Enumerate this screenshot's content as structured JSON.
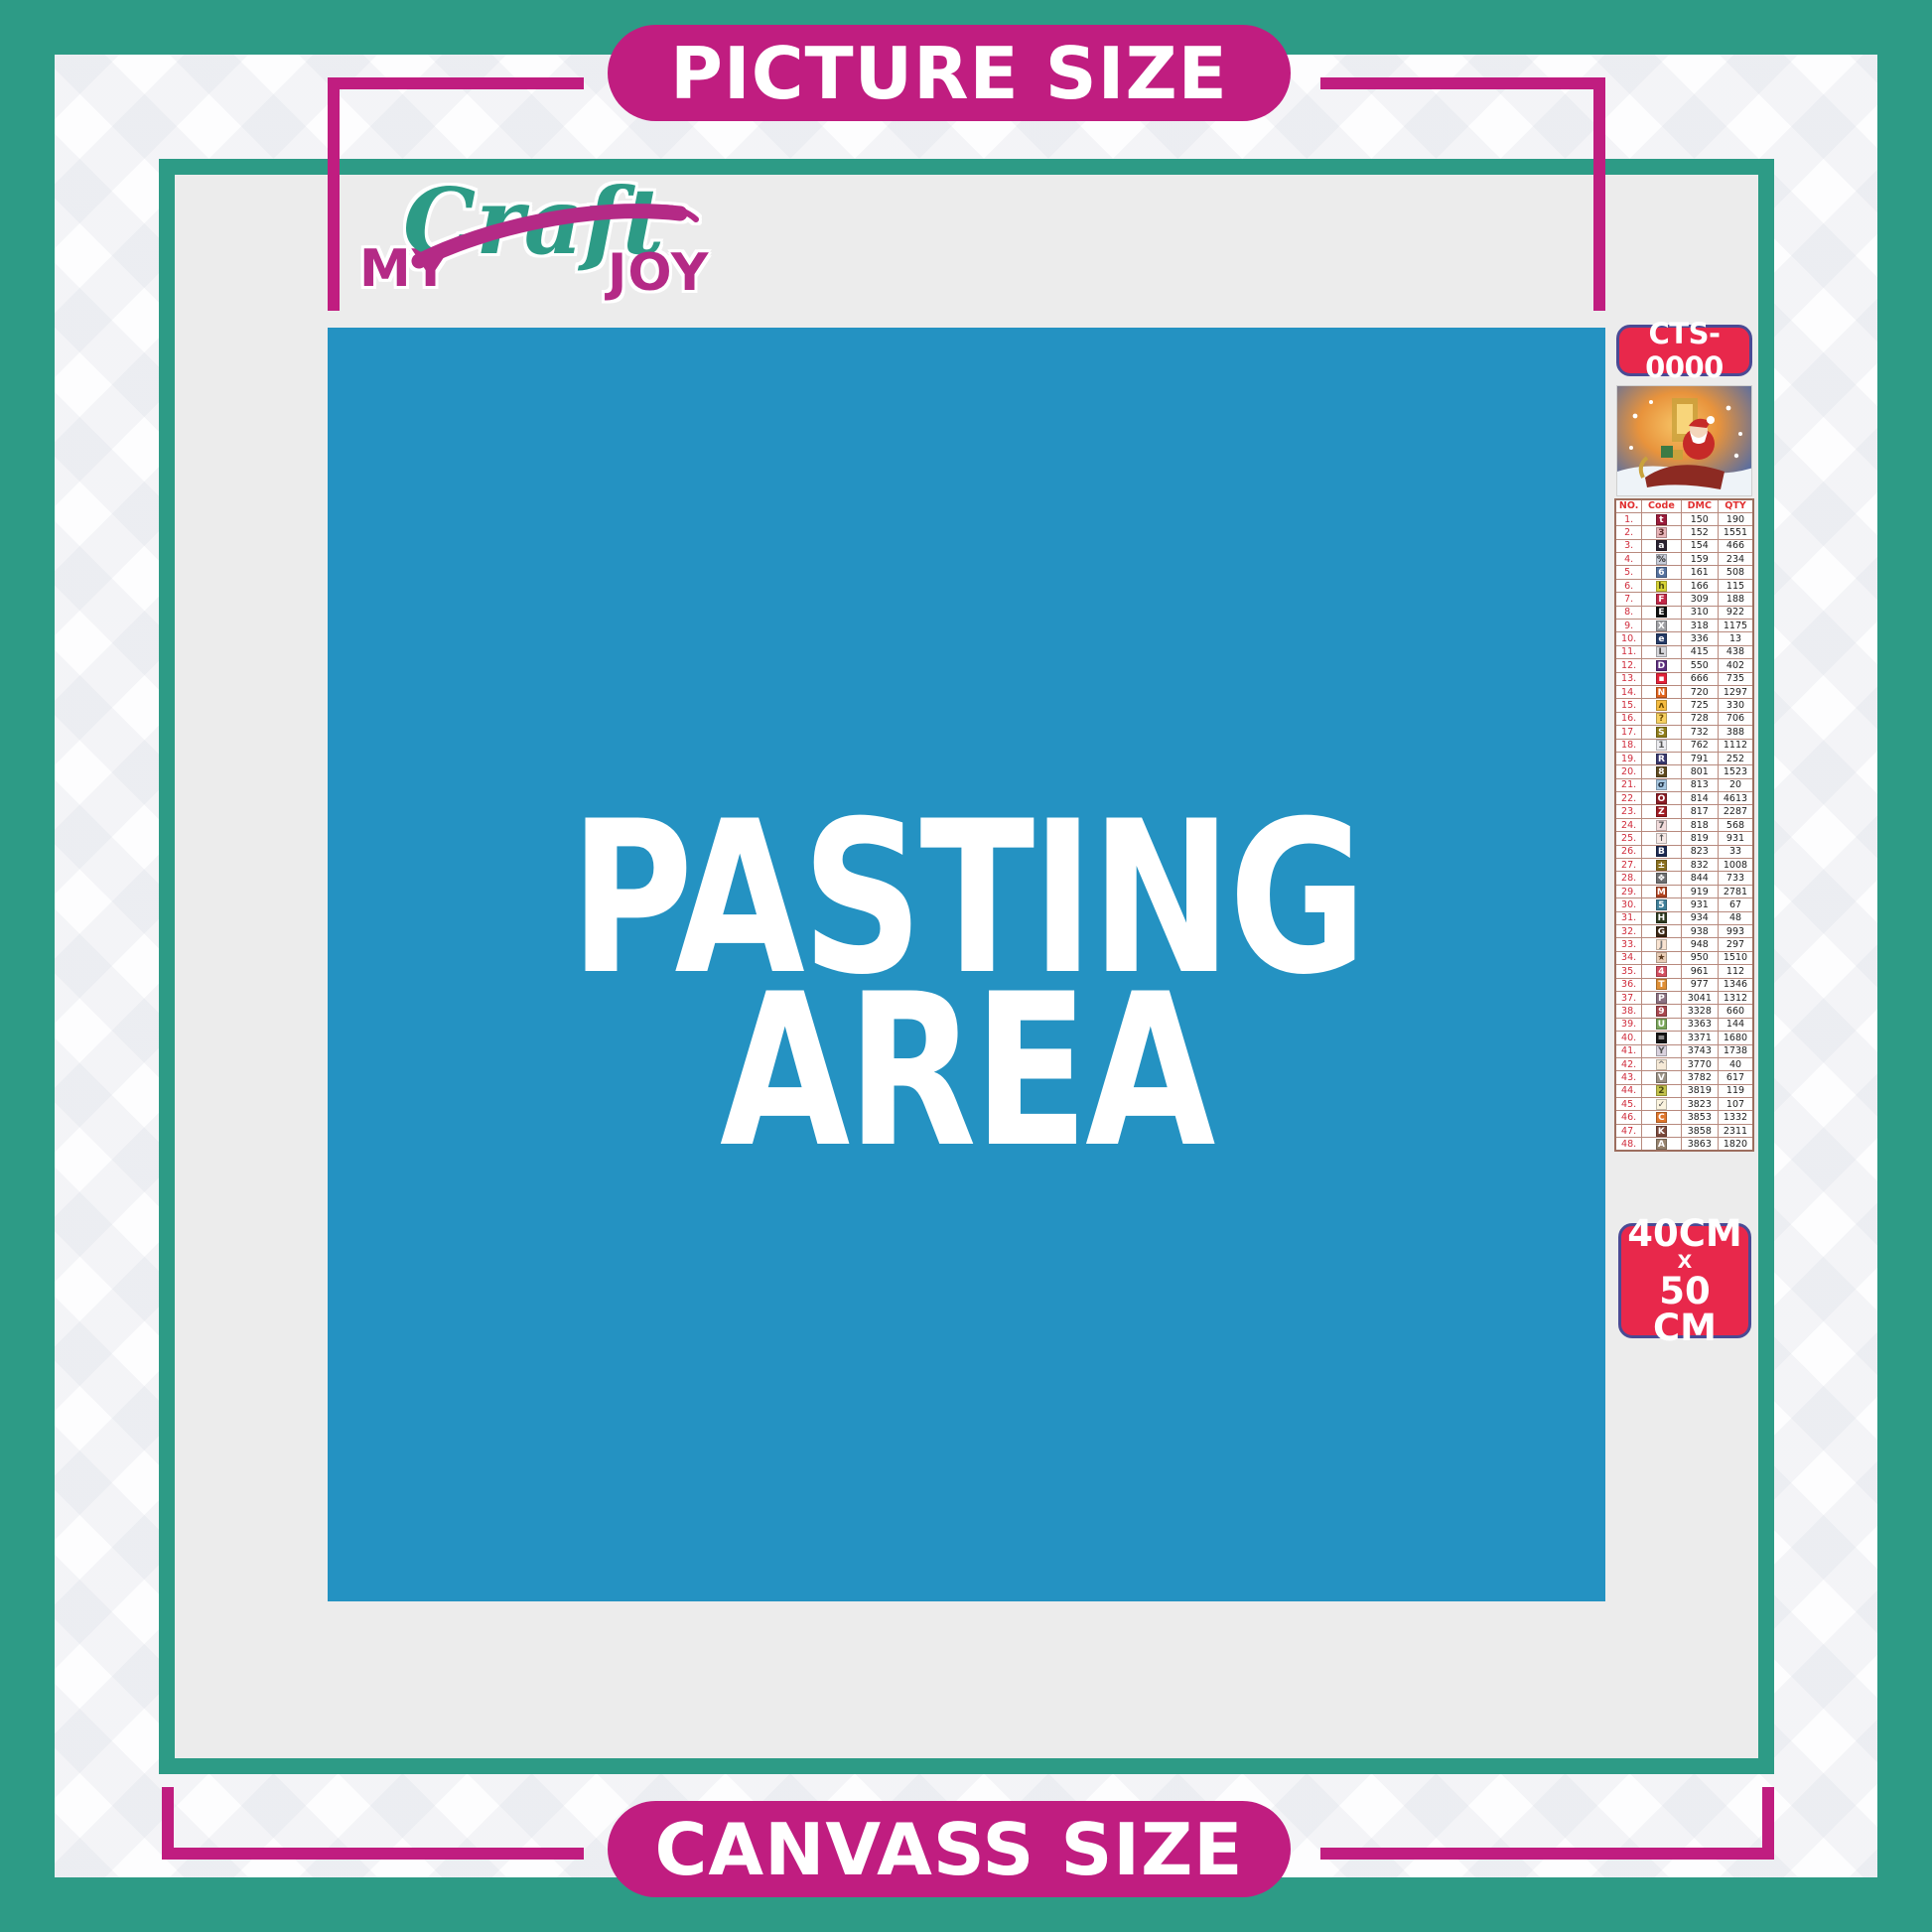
{
  "colors": {
    "teal": "#2d9b86",
    "magenta": "#c01d80",
    "blue": "#2492c2",
    "badge_red": "#e8284b",
    "badge_border": "#4a4a94",
    "content_gray": "#ececec"
  },
  "banners": {
    "top_label": "PICTURE SIZE",
    "bottom_label": "CANVASS SIZE"
  },
  "logo": {
    "word1": "MY",
    "word2": "Craft",
    "word3": "JOY"
  },
  "pasting": {
    "line1": "PASTING",
    "line2": "AREA"
  },
  "product_code": {
    "label": "CTS-0000"
  },
  "size_badge": {
    "width_label": "40CM",
    "x_label": "X",
    "height_label": "50 CM"
  },
  "dmc_table": {
    "headers": {
      "no": "NO.",
      "code": "Code",
      "dmc": "DMC",
      "qty": "QTY"
    },
    "rows": [
      {
        "no": "1.",
        "symbol": "t",
        "symbol_bg": "#9b1b3a",
        "symbol_fg": "#ffffff",
        "dmc": "150",
        "qty": "190"
      },
      {
        "no": "2.",
        "symbol": "3",
        "symbol_bg": "#e8b4b8",
        "symbol_fg": "#5a2a2a",
        "dmc": "152",
        "qty": "1551"
      },
      {
        "no": "3.",
        "symbol": "a",
        "symbol_bg": "#2a2230",
        "symbol_fg": "#ffffff",
        "dmc": "154",
        "qty": "466"
      },
      {
        "no": "4.",
        "symbol": "%",
        "symbol_bg": "#c9cdd9",
        "symbol_fg": "#333333",
        "dmc": "159",
        "qty": "234"
      },
      {
        "no": "5.",
        "symbol": "6",
        "symbol_bg": "#56729f",
        "symbol_fg": "#ffffff",
        "dmc": "161",
        "qty": "508"
      },
      {
        "no": "6.",
        "symbol": "h",
        "symbol_bg": "#d8d437",
        "symbol_fg": "#4a4a10",
        "dmc": "166",
        "qty": "115"
      },
      {
        "no": "7.",
        "symbol": "F",
        "symbol_bg": "#c22746",
        "symbol_fg": "#ffffff",
        "dmc": "309",
        "qty": "188"
      },
      {
        "no": "8.",
        "symbol": "E",
        "symbol_bg": "#101010",
        "symbol_fg": "#ffffff",
        "dmc": "310",
        "qty": "922"
      },
      {
        "no": "9.",
        "symbol": "X",
        "symbol_bg": "#9fa0a4",
        "symbol_fg": "#ffffff",
        "dmc": "318",
        "qty": "1175"
      },
      {
        "no": "10.",
        "symbol": "e",
        "symbol_bg": "#253a66",
        "symbol_fg": "#ffffff",
        "dmc": "336",
        "qty": "13"
      },
      {
        "no": "11.",
        "symbol": "L",
        "symbol_bg": "#d6d6da",
        "symbol_fg": "#444444",
        "dmc": "415",
        "qty": "438"
      },
      {
        "no": "12.",
        "symbol": "D",
        "symbol_bg": "#5c2d7e",
        "symbol_fg": "#ffffff",
        "dmc": "550",
        "qty": "402"
      },
      {
        "no": "13.",
        "symbol": "▪",
        "symbol_bg": "#e42138",
        "symbol_fg": "#ffffff",
        "dmc": "666",
        "qty": "735"
      },
      {
        "no": "14.",
        "symbol": "N",
        "symbol_bg": "#e2631c",
        "symbol_fg": "#ffffff",
        "dmc": "720",
        "qty": "1297"
      },
      {
        "no": "15.",
        "symbol": "ʌ",
        "symbol_bg": "#f5bc41",
        "symbol_fg": "#6b4a00",
        "dmc": "725",
        "qty": "330"
      },
      {
        "no": "16.",
        "symbol": "?",
        "symbol_bg": "#f6cf61",
        "symbol_fg": "#6b4a00",
        "dmc": "728",
        "qty": "706"
      },
      {
        "no": "17.",
        "symbol": "S",
        "symbol_bg": "#8f7d1a",
        "symbol_fg": "#ffffff",
        "dmc": "732",
        "qty": "388"
      },
      {
        "no": "18.",
        "symbol": "1",
        "symbol_bg": "#ececf0",
        "symbol_fg": "#555555",
        "dmc": "762",
        "qty": "1112"
      },
      {
        "no": "19.",
        "symbol": "R",
        "symbol_bg": "#39386e",
        "symbol_fg": "#ffffff",
        "dmc": "791",
        "qty": "252"
      },
      {
        "no": "20.",
        "symbol": "8",
        "symbol_bg": "#5f4a1e",
        "symbol_fg": "#ffffff",
        "dmc": "801",
        "qty": "1523"
      },
      {
        "no": "21.",
        "symbol": "σ",
        "symbol_bg": "#a6c6e0",
        "symbol_fg": "#223344",
        "dmc": "813",
        "qty": "20"
      },
      {
        "no": "22.",
        "symbol": "O",
        "symbol_bg": "#8c1c24",
        "symbol_fg": "#ffffff",
        "dmc": "814",
        "qty": "4613"
      },
      {
        "no": "23.",
        "symbol": "Z",
        "symbol_bg": "#a01b22",
        "symbol_fg": "#ffffff",
        "dmc": "817",
        "qty": "2287"
      },
      {
        "no": "24.",
        "symbol": "7",
        "symbol_bg": "#f2dcdc",
        "symbol_fg": "#555555",
        "dmc": "818",
        "qty": "568"
      },
      {
        "no": "25.",
        "symbol": "↑",
        "symbol_bg": "#f6e9e6",
        "symbol_fg": "#555555",
        "dmc": "819",
        "qty": "931"
      },
      {
        "no": "26.",
        "symbol": "B",
        "symbol_bg": "#1c2a52",
        "symbol_fg": "#ffffff",
        "dmc": "823",
        "qty": "33"
      },
      {
        "no": "27.",
        "symbol": "±",
        "symbol_bg": "#8a701f",
        "symbol_fg": "#ffffff",
        "dmc": "832",
        "qty": "1008"
      },
      {
        "no": "28.",
        "symbol": "❖",
        "symbol_bg": "#6f6f71",
        "symbol_fg": "#ffffff",
        "dmc": "844",
        "qty": "733"
      },
      {
        "no": "29.",
        "symbol": "M",
        "symbol_bg": "#b0421f",
        "symbol_fg": "#ffffff",
        "dmc": "919",
        "qty": "2781"
      },
      {
        "no": "30.",
        "symbol": "5",
        "symbol_bg": "#3f7f99",
        "symbol_fg": "#ffffff",
        "dmc": "931",
        "qty": "67"
      },
      {
        "no": "31.",
        "symbol": "H",
        "symbol_bg": "#2f3a20",
        "symbol_fg": "#ffffff",
        "dmc": "934",
        "qty": "48"
      },
      {
        "no": "32.",
        "symbol": "G",
        "symbol_bg": "#3a2512",
        "symbol_fg": "#ffffff",
        "dmc": "938",
        "qty": "993"
      },
      {
        "no": "33.",
        "symbol": "J",
        "symbol_bg": "#f9e4d2",
        "symbol_fg": "#777777",
        "dmc": "948",
        "qty": "297"
      },
      {
        "no": "34.",
        "symbol": "★",
        "symbol_bg": "#e9cdb6",
        "symbol_fg": "#5a3a20",
        "dmc": "950",
        "qty": "1510"
      },
      {
        "no": "35.",
        "symbol": "4",
        "symbol_bg": "#d44f60",
        "symbol_fg": "#ffffff",
        "dmc": "961",
        "qty": "112"
      },
      {
        "no": "36.",
        "symbol": "T",
        "symbol_bg": "#df8f35",
        "symbol_fg": "#ffffff",
        "dmc": "977",
        "qty": "1346"
      },
      {
        "no": "37.",
        "symbol": "P",
        "symbol_bg": "#8b7181",
        "symbol_fg": "#ffffff",
        "dmc": "3041",
        "qty": "1312"
      },
      {
        "no": "38.",
        "symbol": "9",
        "symbol_bg": "#a8474e",
        "symbol_fg": "#ffffff",
        "dmc": "3328",
        "qty": "660"
      },
      {
        "no": "39.",
        "symbol": "U",
        "symbol_bg": "#7aa65a",
        "symbol_fg": "#ffffff",
        "dmc": "3363",
        "qty": "144"
      },
      {
        "no": "40.",
        "symbol": "=",
        "symbol_bg": "#141414",
        "symbol_fg": "#ffffff",
        "dmc": "3371",
        "qty": "1680"
      },
      {
        "no": "41.",
        "symbol": "Y",
        "symbol_bg": "#d9d2de",
        "symbol_fg": "#555555",
        "dmc": "3743",
        "qty": "1738"
      },
      {
        "no": "42.",
        "symbol": "^",
        "symbol_bg": "#f6ead7",
        "symbol_fg": "#777777",
        "dmc": "3770",
        "qty": "40"
      },
      {
        "no": "43.",
        "symbol": "V",
        "symbol_bg": "#9a9184",
        "symbol_fg": "#ffffff",
        "dmc": "3782",
        "qty": "617"
      },
      {
        "no": "44.",
        "symbol": "2",
        "symbol_bg": "#c3c24b",
        "symbol_fg": "#4a4a10",
        "dmc": "3819",
        "qty": "119"
      },
      {
        "no": "45.",
        "symbol": "✓",
        "symbol_bg": "#fbf4df",
        "symbol_fg": "#555555",
        "dmc": "3823",
        "qty": "107"
      },
      {
        "no": "46.",
        "symbol": "C",
        "symbol_bg": "#e0762b",
        "symbol_fg": "#ffffff",
        "dmc": "3853",
        "qty": "1332"
      },
      {
        "no": "47.",
        "symbol": "K",
        "symbol_bg": "#7d4a3c",
        "symbol_fg": "#ffffff",
        "dmc": "3858",
        "qty": "2311"
      },
      {
        "no": "48.",
        "symbol": "A",
        "symbol_bg": "#97846f",
        "symbol_fg": "#ffffff",
        "dmc": "3863",
        "qty": "1820"
      }
    ]
  }
}
